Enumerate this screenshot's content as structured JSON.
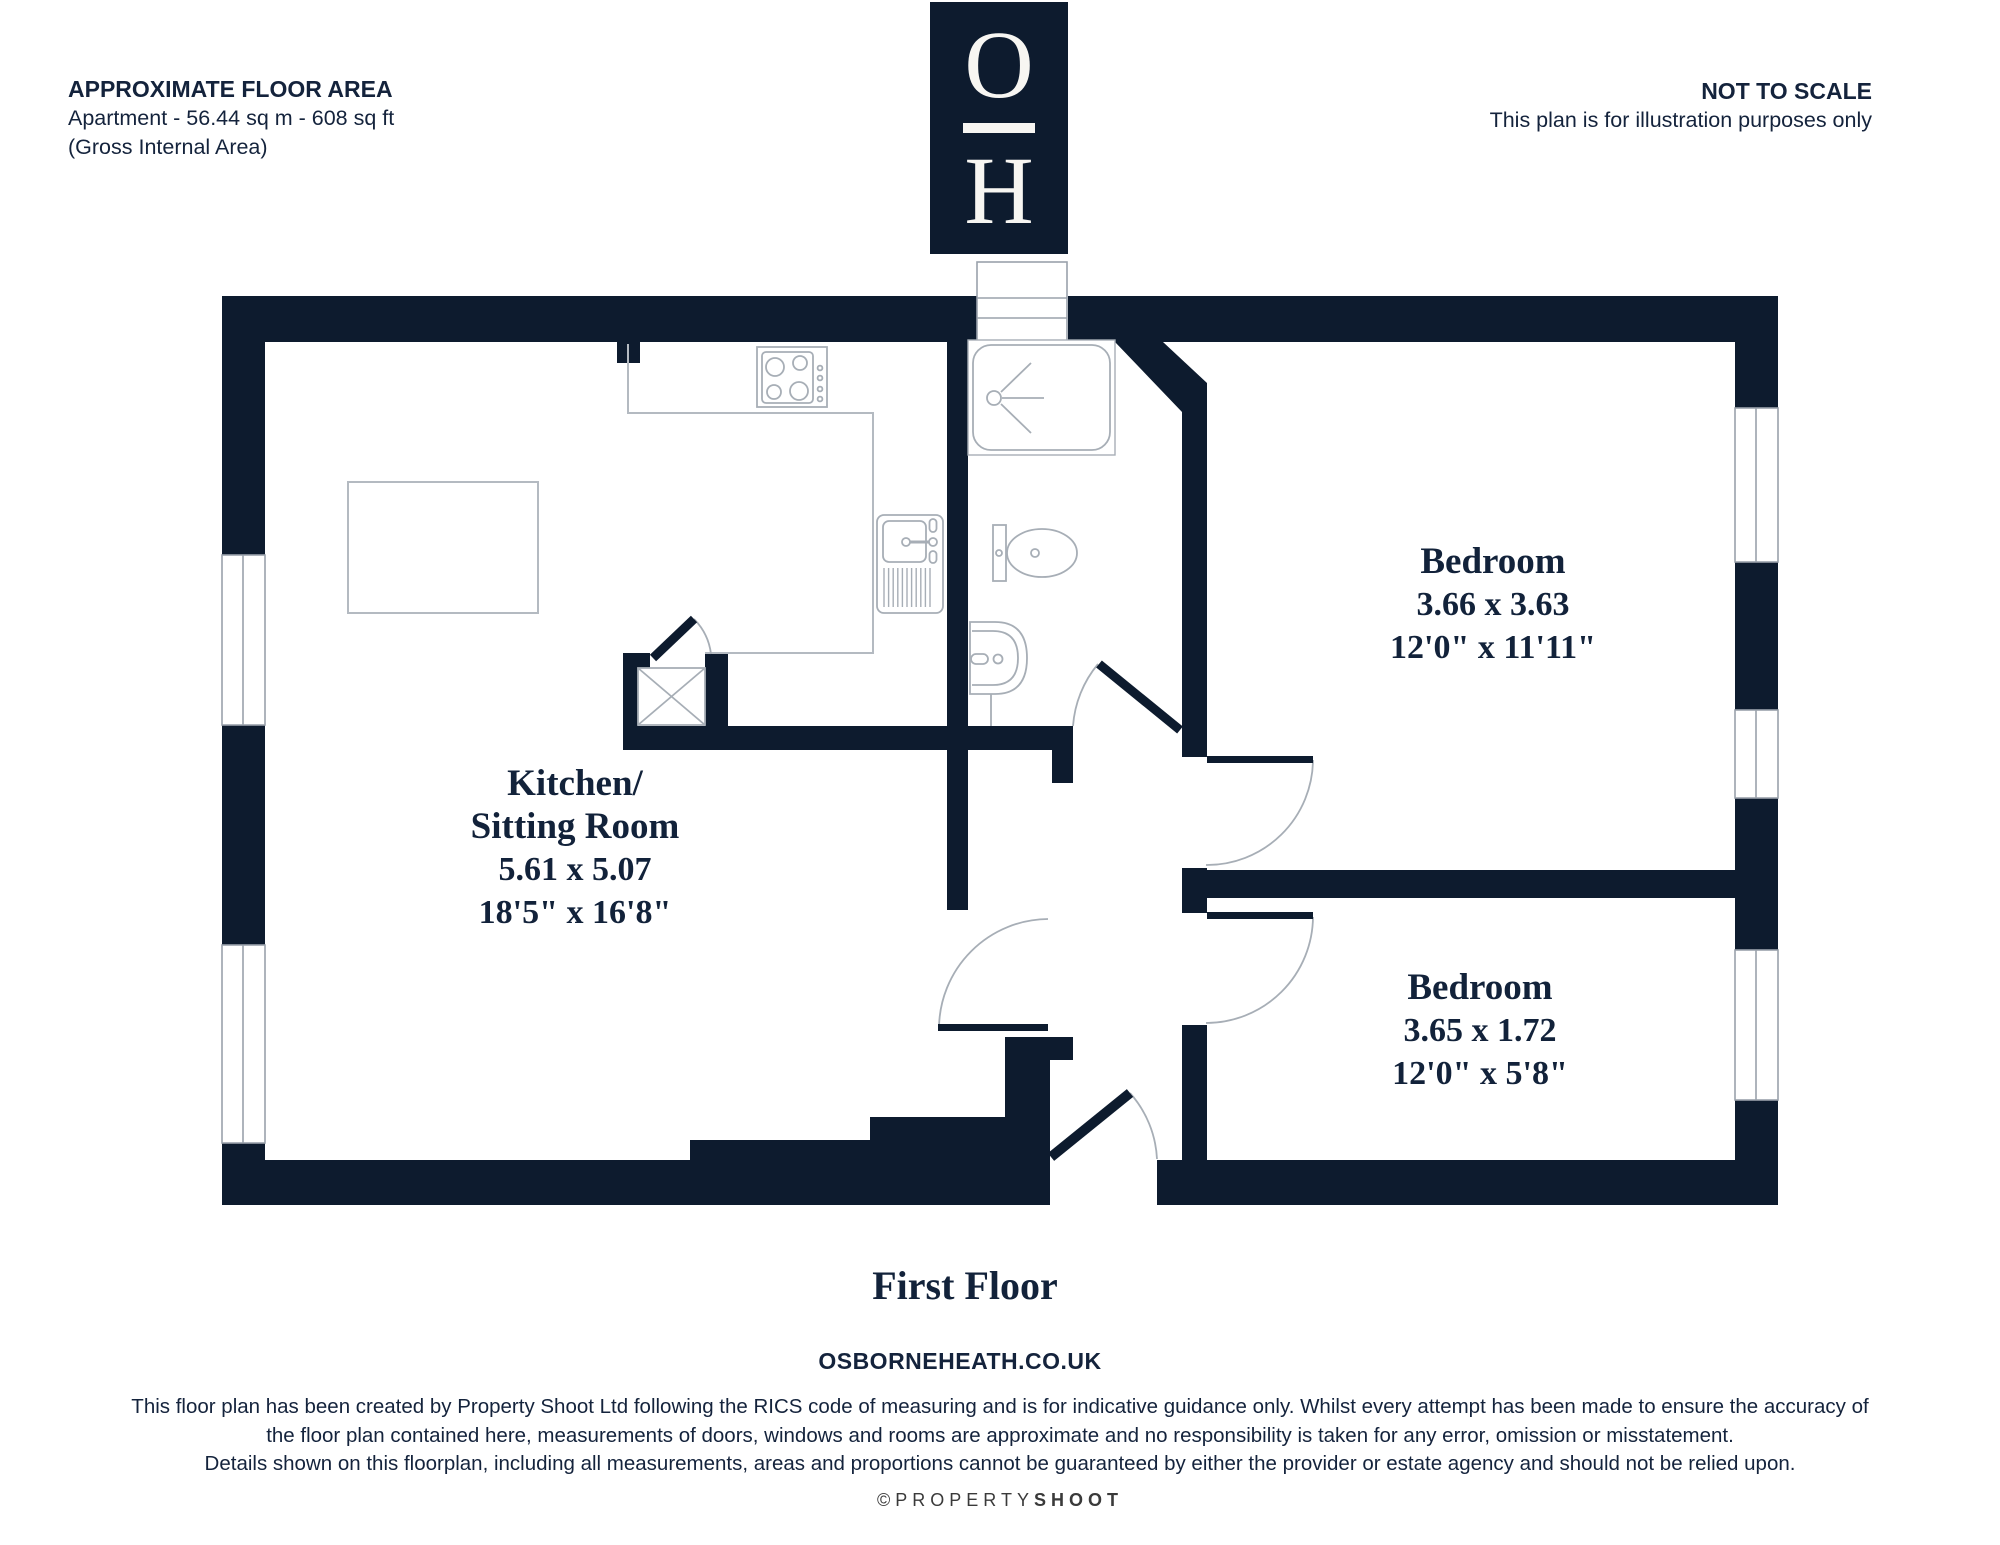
{
  "header": {
    "floor_area_title": "APPROXIMATE FLOOR AREA",
    "floor_area_line1": "Apartment - 56.44 sq m - 608 sq ft",
    "floor_area_line2": "(Gross Internal Area)",
    "scale_title": "NOT TO SCALE",
    "scale_line1": "This plan is for illustration purposes only"
  },
  "logo": {
    "top_letter": "O",
    "bottom_letter": "H"
  },
  "plan": {
    "rooms": {
      "kitchen": {
        "name_line1": "Kitchen/",
        "name_line2": "Sitting Room",
        "metric": "5.61 x 5.07",
        "imperial": "18'5\" x 16'8\""
      },
      "bedroom1": {
        "name": "Bedroom",
        "metric": "3.66 x 3.63",
        "imperial": "12'0\" x 11'11\""
      },
      "bedroom2": {
        "name": "Bedroom",
        "metric": "3.65 x 1.72",
        "imperial": "12'0\" x 5'8\""
      }
    },
    "floor_label": "First Floor",
    "fixtures": [
      "shower",
      "toilet",
      "basin",
      "hob",
      "sink",
      "storage-cupboard"
    ]
  },
  "footer": {
    "website": "OSBORNEHEATH.CO.UK",
    "disclaimer_line1": "This floor plan has been created by Property Shoot Ltd following the RICS code of measuring and is for indicative guidance only. Whilst every attempt has been made to ensure the accuracy of",
    "disclaimer_line2": "the floor plan contained here, measurements of doors, windows and rooms are approximate and no responsibility is taken for any error, omission or misstatement.",
    "disclaimer_line3": "Details shown on this floorplan, including all measurements, areas and proportions cannot be guaranteed by either the provider or estate agency and should not be relied upon.",
    "credit_light": "©PROPERTY",
    "credit_bold": "SHOOT"
  },
  "colors": {
    "wall": "#0d1b2e",
    "fixture_line": "#a7aeb6",
    "text": "#14233c"
  }
}
